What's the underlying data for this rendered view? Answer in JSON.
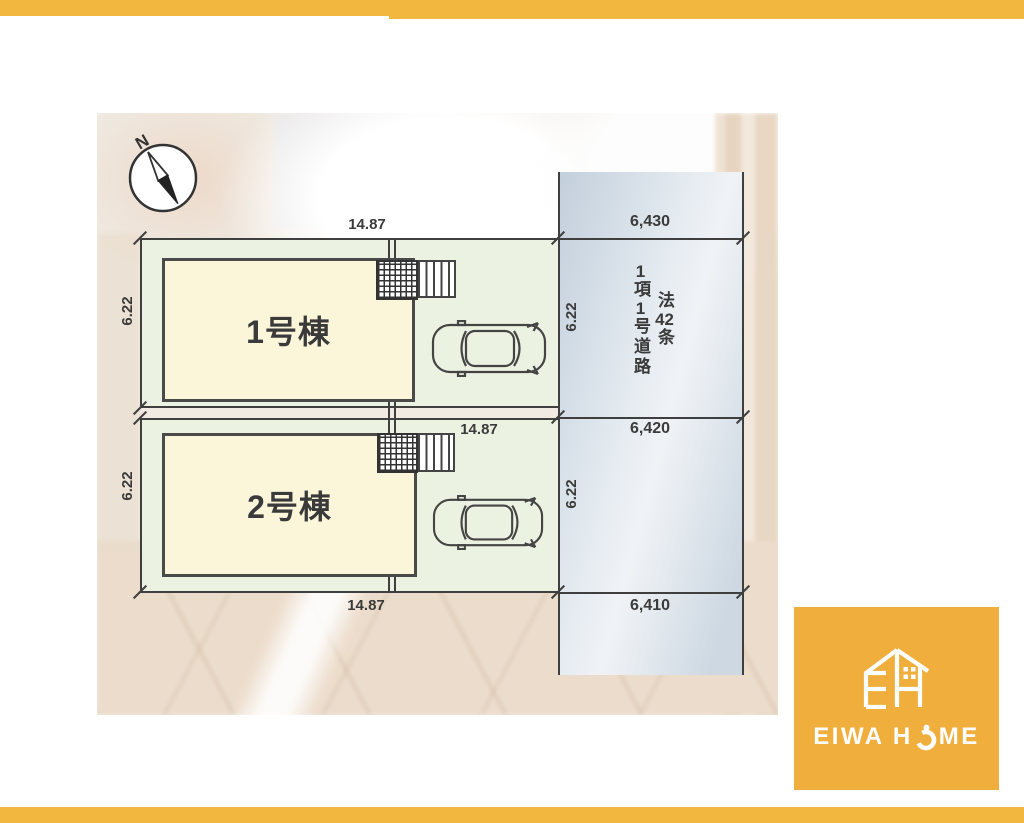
{
  "brand": "EIWA HOME",
  "colors": {
    "accent_orange": "#F2B73E",
    "logo_orange": "#F0AE3C",
    "building_cream": "#FBF6DA",
    "lot_green": "#EBF2E2",
    "road_blue": "#C9D5E1",
    "line_dark": "#3F3F3F"
  },
  "compass": {
    "label": "N"
  },
  "site": {
    "frontage_top": "14.87",
    "frontage_mid": "14.87",
    "frontage_bottom": "14.87",
    "lot1_depth": "6.22",
    "lot2_depth": "6.22",
    "road1_depth": "6.22",
    "road2_depth": "6.22",
    "buildings": [
      {
        "label": "1号棟"
      },
      {
        "label": "2号棟"
      }
    ]
  },
  "road": {
    "widths": [
      "6,430",
      "6,420",
      "6,410"
    ],
    "law_col": {
      "p1": "法",
      "num": "42",
      "p2": "条"
    },
    "item_col": {
      "n1": "1",
      "p1": "項",
      "n2": "1",
      "p2": "号道路"
    }
  },
  "logo": {
    "pre": "EIWA H",
    "post": "ME"
  }
}
